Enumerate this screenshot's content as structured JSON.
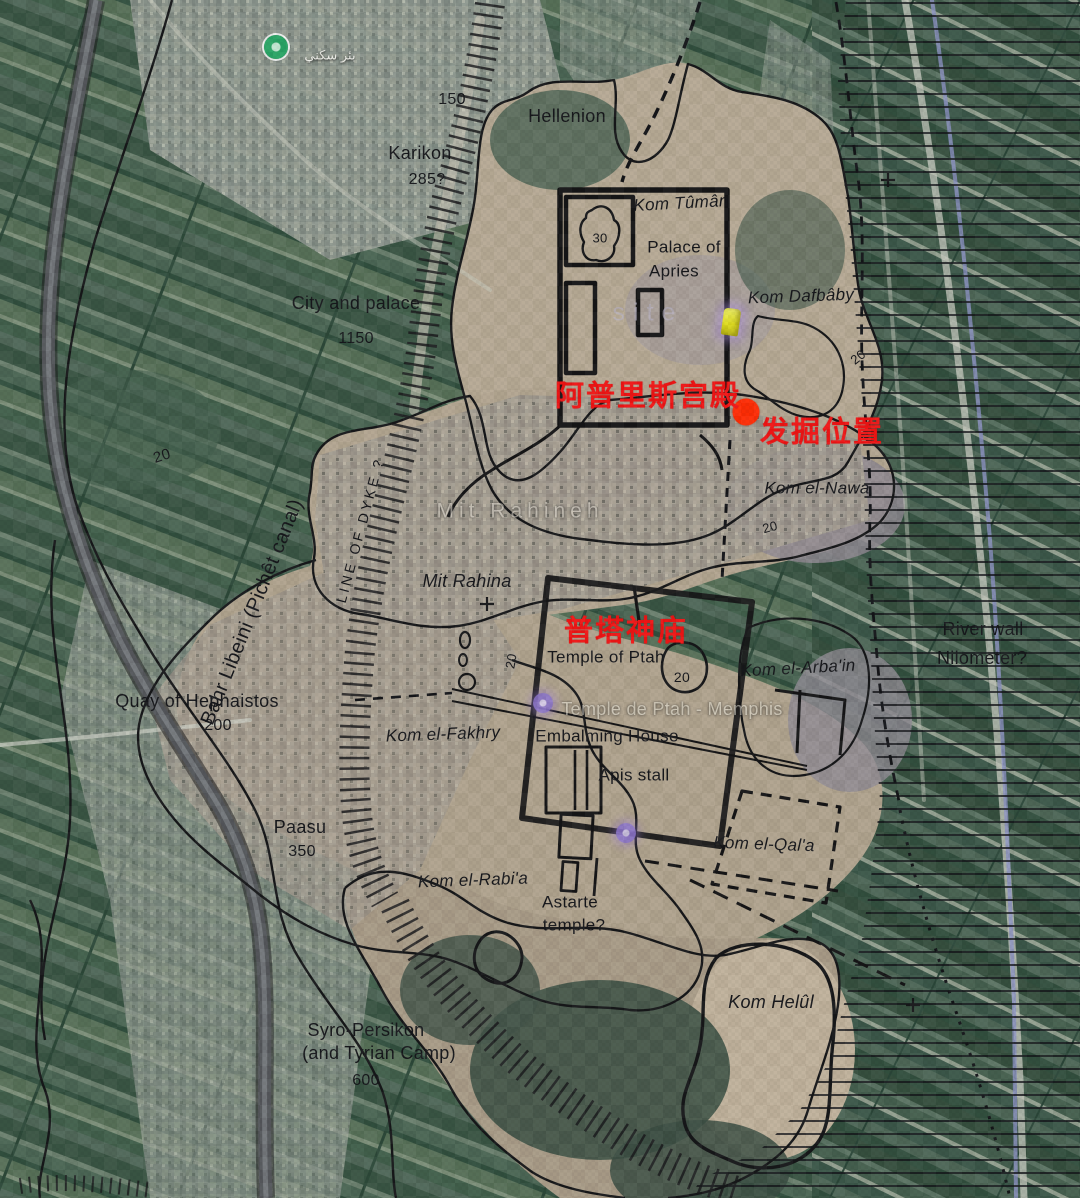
{
  "map": {
    "description": "Annotated archaeological survey map of Memphis (Mit Rahina, Egypt) over satellite imagery, with Chinese excavation annotations",
    "colors": {
      "annotation_red": "#f11616",
      "contour_black": "#17181a",
      "farmland_green": "#46604e",
      "desert_tan": "#b7aa95",
      "canal_gray": "#55585c",
      "marker_yellow": "#e2df25",
      "marker_green": "#2aa565",
      "marker_purple": "#8d76cc"
    },
    "labels": {
      "canal": "Bahr Libeini (Pichêt canal)",
      "arabic_poi": "بئر سكني",
      "contour_150": "150",
      "hellenion": "Hellenion",
      "karikon": "Karikon",
      "karikon_area": "285?",
      "kom_tuman": "Kom Tûmân",
      "palace_line1": "Palace of",
      "palace_line2": "Apries",
      "mound_30": "30",
      "kom_dafbaby": "Kom Dafbâby",
      "city_palace": "City and palace",
      "city_palace_area": "1150",
      "site_watermark": "site",
      "kom_elnawa": "Kom el-Nawa",
      "mit_rahineh_faded": "Mit Rahineh",
      "line_of_dyke": "LINE OF DYKE ?",
      "mit_rahina": "Mit Rahina",
      "temple_ptah": "Temple of Ptah",
      "kom_elarbain": "Kom el-Arba'in",
      "river_wall": "River wall",
      "nilometer": "Nilometer?",
      "quay": "Quay of Hephaistos",
      "quay_area": "200",
      "kom_elfakhry": "Kom el-Fakhry",
      "gmaps_ptah": "Temple de Ptah - Memphis",
      "embalming": "Embalming House",
      "apis": "Apis stall",
      "paasu": "Paasu",
      "paasu_area": "350",
      "kom_elqala": "Kom el-Qal'a",
      "kom_elrabia": "Kom el-Rabi'a",
      "astarte_line1": "Astarte",
      "astarte_line2": "temple?",
      "kom_helul": "Kom Helûl",
      "syro_line1": "Syro-Persikon",
      "syro_line2": "(and Tyrian Camp)",
      "syro_area": "600",
      "cn_palace": "阿普里斯宫殿",
      "cn_excavation": "发掘位置",
      "cn_temple": "普塔神庙"
    },
    "contour_labels": {
      "c20_west": "20",
      "c20_dafbaby": "20",
      "c20_nawa": "20",
      "c20_ptah_blob": "20",
      "c20_ptah_west": "20"
    },
    "markers": {
      "excavation_dot": "red-dot",
      "site_pin": "yellow-pushpin",
      "poi_green": "green-circle",
      "poi_purple_temple": "purple-circle",
      "poi_purple_south": "purple-circle"
    }
  }
}
